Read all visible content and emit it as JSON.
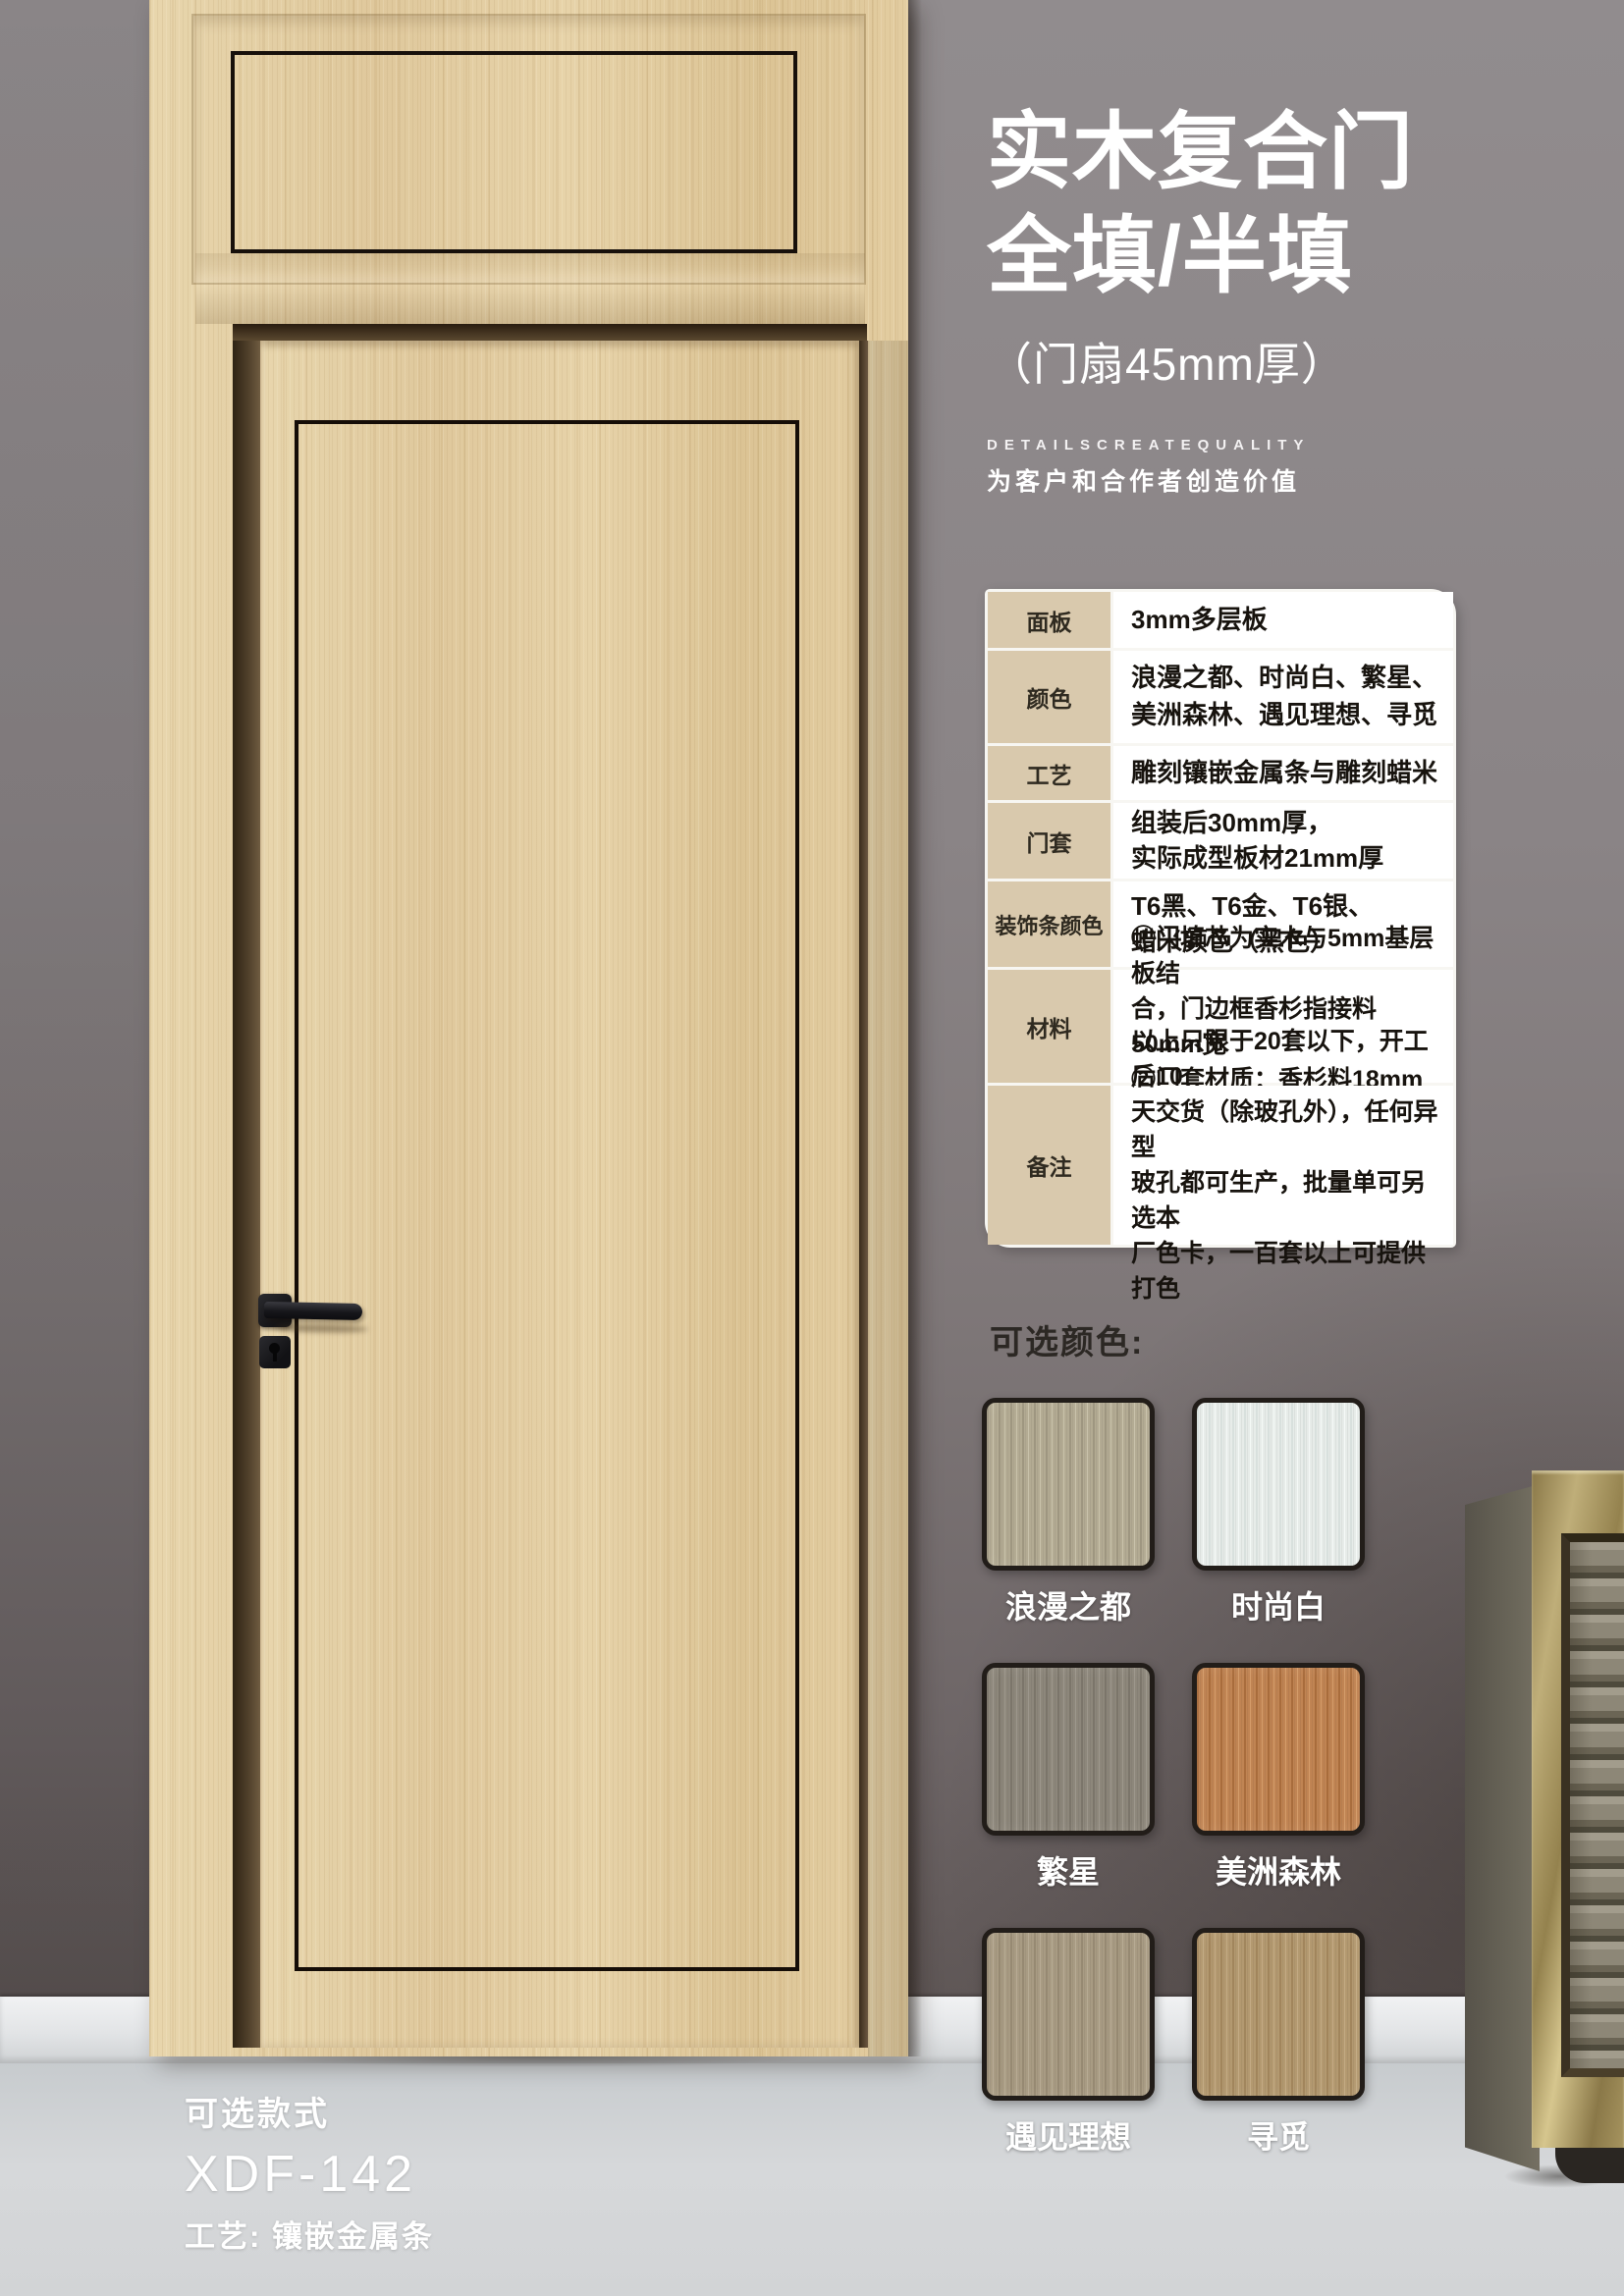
{
  "poster": {
    "title_line1": "实木复合门",
    "title_line2": "全填/半填",
    "subtitle": "（门扇45mm厚）",
    "tagline_en": "DETAILSCREATEQUALITY",
    "tagline_cn": "为客户和合作者创造价值"
  },
  "spec_table": {
    "rows": [
      {
        "label": "面板",
        "value": "3mm多层板"
      },
      {
        "label": "颜色",
        "value": "浪漫之都、时尚白、繁星、\n美洲森林、遇见理想、寻觅"
      },
      {
        "label": "工艺",
        "value": "雕刻镶嵌金属条与雕刻蜡米"
      },
      {
        "label": "门套",
        "value": "组装后30mm厚，\n实际成型板材21mm厚"
      },
      {
        "label": "装饰条颜色",
        "value": "T6黑、T6金、T6银、\n蜡米颜色（黑色）"
      },
      {
        "label": "材料",
        "value": "①门填芯为实木与5mm基层板结\n合，门边框香杉指接料50mm宽\n②门套材质：香杉料18mm厚"
      },
      {
        "label": "备注",
        "value": "以上只限于20套以下，开工后10\n天交货（除玻孔外），任何异型\n玻孔都可生产，批量单可另选本\n厂色卡，一百套以上可提供打色"
      }
    ]
  },
  "colors_section": {
    "heading": "可选颜色:",
    "swatches": [
      {
        "name": "浪漫之都",
        "base": "#b3ab93",
        "dark": "#9e9680",
        "light": "#c9c2ab"
      },
      {
        "name": "时尚白",
        "base": "#e7ece9",
        "dark": "#d8e0dd",
        "light": "#f5f9f7"
      },
      {
        "name": "繁星",
        "base": "#8d877b",
        "dark": "#7b756a",
        "light": "#9d978c"
      },
      {
        "name": "美洲森林",
        "base": "#c08453",
        "dark": "#a86c3c",
        "light": "#d49c6a"
      },
      {
        "name": "遇见理想",
        "base": "#a89b83",
        "dark": "#968972",
        "light": "#b7ab94"
      },
      {
        "name": "寻觅",
        "base": "#b39970",
        "dark": "#a1855c",
        "light": "#c3aa84"
      }
    ]
  },
  "style_info": {
    "heading": "可选款式",
    "model": "XDF-142",
    "craft": "工艺: 镶嵌金属条"
  },
  "scene": {
    "wall_color": "#8a8486",
    "floor_color": "#ccd0d3",
    "wood_color": "#e3cda1",
    "inlay_color": "#17100b",
    "cabinet_gold": "#a6945f",
    "table_label_bg": "#d9c9ad"
  }
}
